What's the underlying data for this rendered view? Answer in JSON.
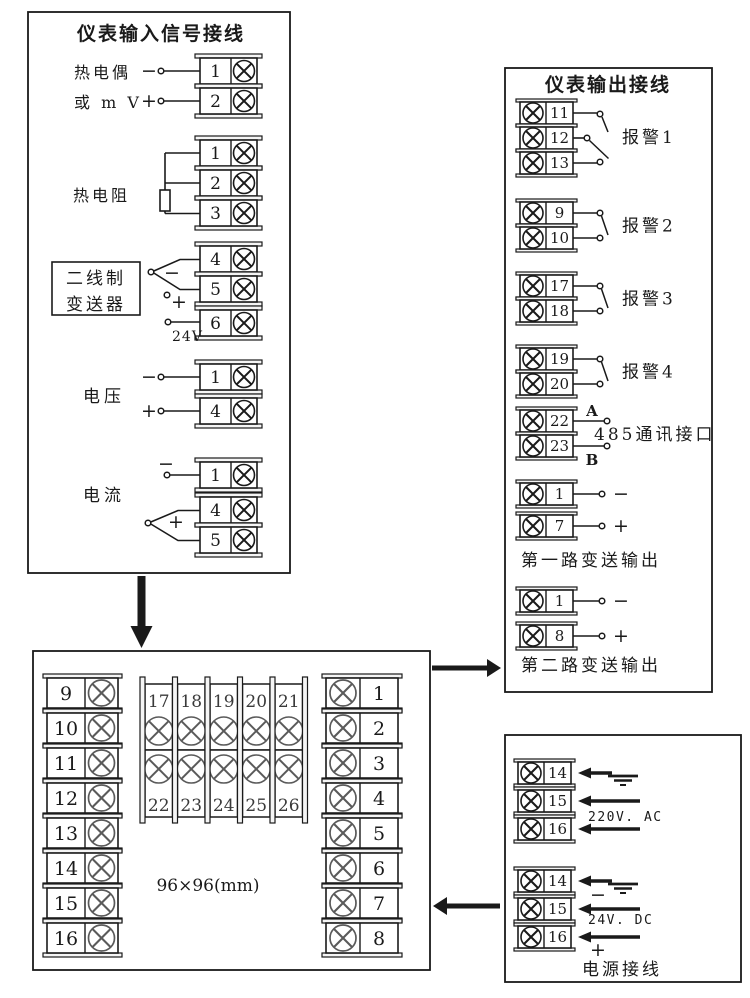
{
  "diagram": {
    "ink": "#1a1a1a",
    "input_box": {
      "title": "仪表输入信号接线",
      "thermocouple": {
        "label1": "热电偶",
        "label2": "或 m V",
        "minus": "−",
        "plus": "+",
        "terminals": [
          "1",
          "2"
        ]
      },
      "rtd": {
        "label": "热电阻",
        "terminals": [
          "1",
          "2",
          "3"
        ]
      },
      "transmitter": {
        "line1": "二线制",
        "line2": "变送器",
        "minus": "−",
        "plus": "+",
        "supply": "24V",
        "terminals": [
          "4",
          "5",
          "6"
        ]
      },
      "voltage": {
        "label": "电压",
        "minus": "−",
        "plus": "+",
        "terminals": [
          "1",
          "4"
        ]
      },
      "current": {
        "label": "电流",
        "minus": "−",
        "plus": "+",
        "terminals": [
          "1",
          "4",
          "5"
        ]
      }
    },
    "output_box": {
      "title": "仪表输出接线",
      "alarms": [
        {
          "label": "报警1",
          "terminals": [
            "11",
            "12",
            "13"
          ]
        },
        {
          "label": "报警2",
          "terminals": [
            "9",
            "10"
          ]
        },
        {
          "label": "报警3",
          "terminals": [
            "17",
            "18"
          ]
        },
        {
          "label": "报警4",
          "terminals": [
            "19",
            "20"
          ]
        }
      ],
      "comm": {
        "label": "485通讯接口",
        "a": "A",
        "b": "B",
        "terminals": [
          "22",
          "23"
        ]
      },
      "transmit": [
        {
          "label": "第一路变送输出",
          "minus": "−",
          "plus": "+",
          "terminals": [
            "1",
            "7"
          ]
        },
        {
          "label": "第二路变送输出",
          "minus": "−",
          "plus": "+",
          "terminals": [
            "1",
            "8"
          ]
        }
      ]
    },
    "layout_box": {
      "left_column": [
        "9",
        "10",
        "11",
        "12",
        "13",
        "14",
        "15",
        "16"
      ],
      "middle_top": [
        "17",
        "18",
        "19",
        "20",
        "21"
      ],
      "middle_bottom": [
        "22",
        "23",
        "24",
        "25",
        "26"
      ],
      "right_column": [
        "1",
        "2",
        "3",
        "4",
        "5",
        "6",
        "7",
        "8"
      ],
      "size_label": "96×96(mm)"
    },
    "power_box": {
      "title": "电源接线",
      "ac": {
        "label": "220V. AC",
        "terminals": [
          "14",
          "15",
          "16"
        ]
      },
      "dc": {
        "label": "24V. DC",
        "minus": "−",
        "plus": "+",
        "terminals": [
          "14",
          "15",
          "16"
        ]
      }
    }
  }
}
